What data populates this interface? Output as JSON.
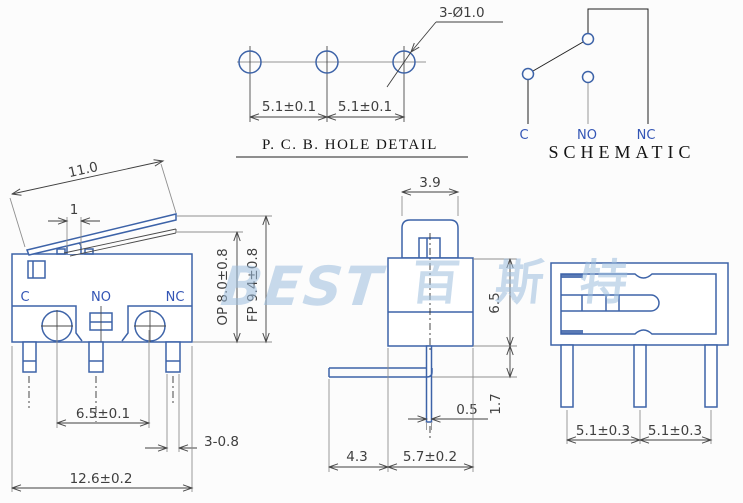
{
  "colors": {
    "part": "#3d63a8",
    "dim": "#3f3f3f",
    "ext": "#8f8f8f",
    "label": "#3355b5",
    "dark": "#1f1f1f",
    "watermark": "#9dbede",
    "bg": "#fcfcfc"
  },
  "watermark": {
    "latin": "BEST",
    "cjk": "百斯特"
  },
  "pcb_detail": {
    "title": "P. C. B.  HOLE DETAIL",
    "callout": "3-Ø1.0",
    "pitch_left": "5.1±0.1",
    "pitch_right": "5.1±0.1"
  },
  "schematic": {
    "title": "SCHEMATIC",
    "terminal_c": "C",
    "terminal_no": "NO",
    "terminal_nc": "NC"
  },
  "front_view": {
    "terminal_c": "C",
    "terminal_no": "NO",
    "terminal_nc": "NC",
    "lever_length": "11.0",
    "plunger_width": "1",
    "op_height": "OP 8.0±0.8",
    "fp_height": "FP 9.4±0.8",
    "terminal_span": "6.5±0.1",
    "pin_width": "3-0.8",
    "body_width": "12.6±0.2"
  },
  "side_view": {
    "cap_width": "3.9",
    "body_height": "6.5",
    "pin_offset": "1.7",
    "pin_thickness": "0.5",
    "lever_overhang": "4.3",
    "body_depth": "5.7±0.2"
  },
  "end_view": {
    "pin_pitch_left": "5.1±0.3",
    "pin_pitch_right": "5.1±0.3"
  }
}
